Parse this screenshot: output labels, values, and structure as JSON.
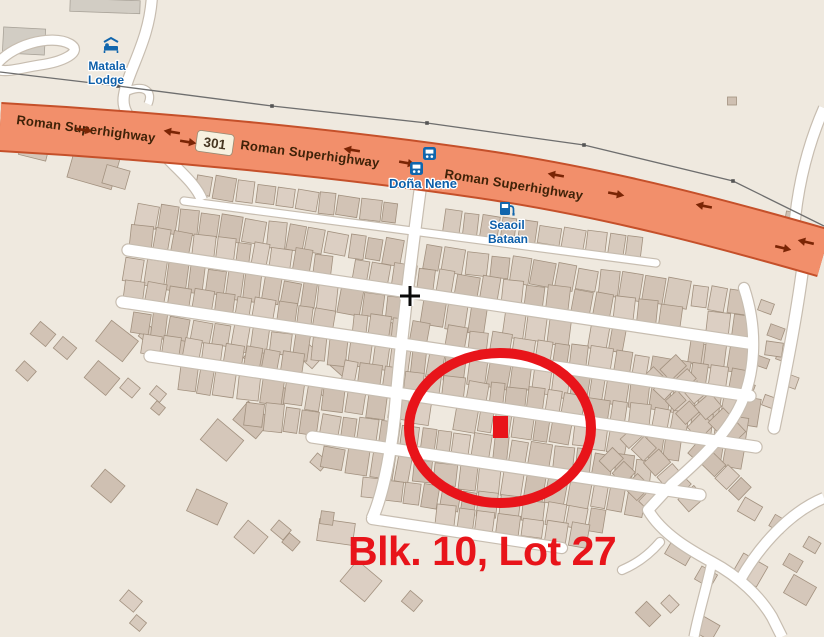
{
  "map": {
    "land_color": "#efe9df",
    "building_color": "#d5c7ba",
    "road_color": "#ffffff",
    "highway": {
      "name": "Roman Superhighway",
      "route_ref": "301",
      "fill_color": "#f28f6b",
      "casing_color": "#c5502a",
      "oneway_arrow_color": "#7a2505"
    },
    "power_line_color": "#6e6e6e",
    "poi_label_color": "#0d5faa",
    "poi_icon_color": "#1166ad",
    "pois": [
      {
        "id": "matala-lodge",
        "icon": "lodge-icon",
        "lines": [
          "Matala",
          "Lodge"
        ]
      },
      {
        "id": "dona-nene",
        "icon": "bus-stop-icon",
        "lines": [
          "Doña Nene"
        ]
      },
      {
        "id": "seaoil-bataan",
        "icon": "fuel-icon",
        "lines": [
          "Seaoil",
          "Bataan"
        ]
      }
    ]
  },
  "annotation": {
    "label": "Blk. 10, Lot 27",
    "color": "#e8141a",
    "shape": "ellipse-with-square-marker"
  },
  "cursor": {
    "type": "crosshair"
  }
}
